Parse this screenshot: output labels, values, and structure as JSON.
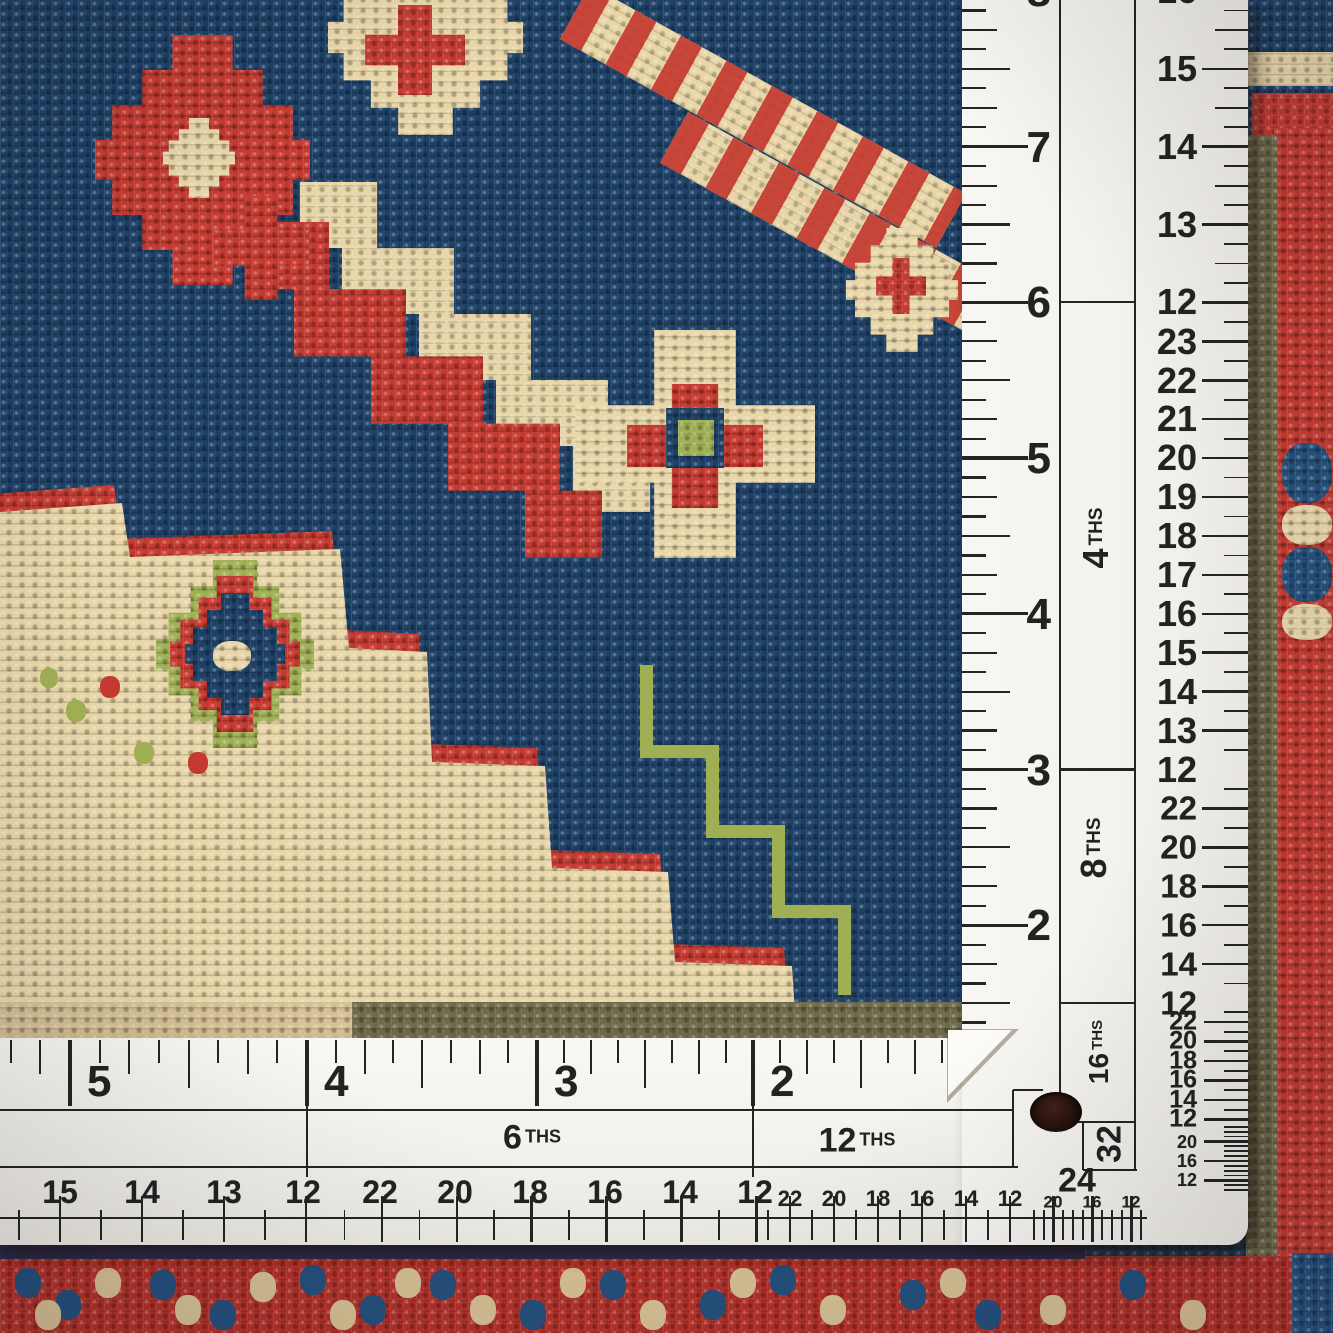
{
  "scene": {
    "subject": "Close-up photograph of a hand-knotted wool rug in navy, red, cream and green, measured with a white L-shaped multi-scale ruler along the bottom and right edges",
    "colors": {
      "rug_navy": "#1d4066",
      "rug_red": "#c43a30",
      "rug_cream": "#e8d6a8",
      "rug_green": "#9fb054",
      "ruler_white": "#f6f5f1",
      "ruler_ink": "#222222"
    }
  },
  "vertical_ruler": {
    "inch_numbers": [
      "8",
      "7",
      "6",
      "5",
      "4",
      "3",
      "2"
    ],
    "sections": [
      {
        "label": "",
        "numbers": [
          "16",
          "15",
          "14",
          "13",
          "12"
        ]
      },
      {
        "label": "4THS",
        "numbers": [
          "23",
          "22",
          "21",
          "20",
          "19",
          "18",
          "17",
          "16",
          "15",
          "14",
          "13",
          "12"
        ]
      },
      {
        "label": "8THS",
        "numbers": [
          "22",
          "20",
          "18",
          "16",
          "14",
          "12"
        ]
      },
      {
        "label": "16THS",
        "numbers": [
          "22",
          "20",
          "18",
          "16",
          "14",
          "12"
        ]
      },
      {
        "label": "32",
        "numbers": [
          "20",
          "16",
          "12"
        ]
      }
    ]
  },
  "horizontal_ruler": {
    "inch_numbers": [
      "5",
      "4",
      "3",
      "2"
    ],
    "sections": [
      {
        "label": "",
        "numbers": [
          "15",
          "14",
          "13",
          "12"
        ]
      },
      {
        "label": "6THS",
        "numbers": [
          "22",
          "20",
          "18",
          "16",
          "14",
          "12"
        ]
      },
      {
        "label": "12THS",
        "numbers": [
          "22",
          "20",
          "18",
          "16",
          "14",
          "12"
        ]
      },
      {
        "label": "24",
        "numbers": [
          "20",
          "16",
          "12"
        ]
      }
    ]
  }
}
